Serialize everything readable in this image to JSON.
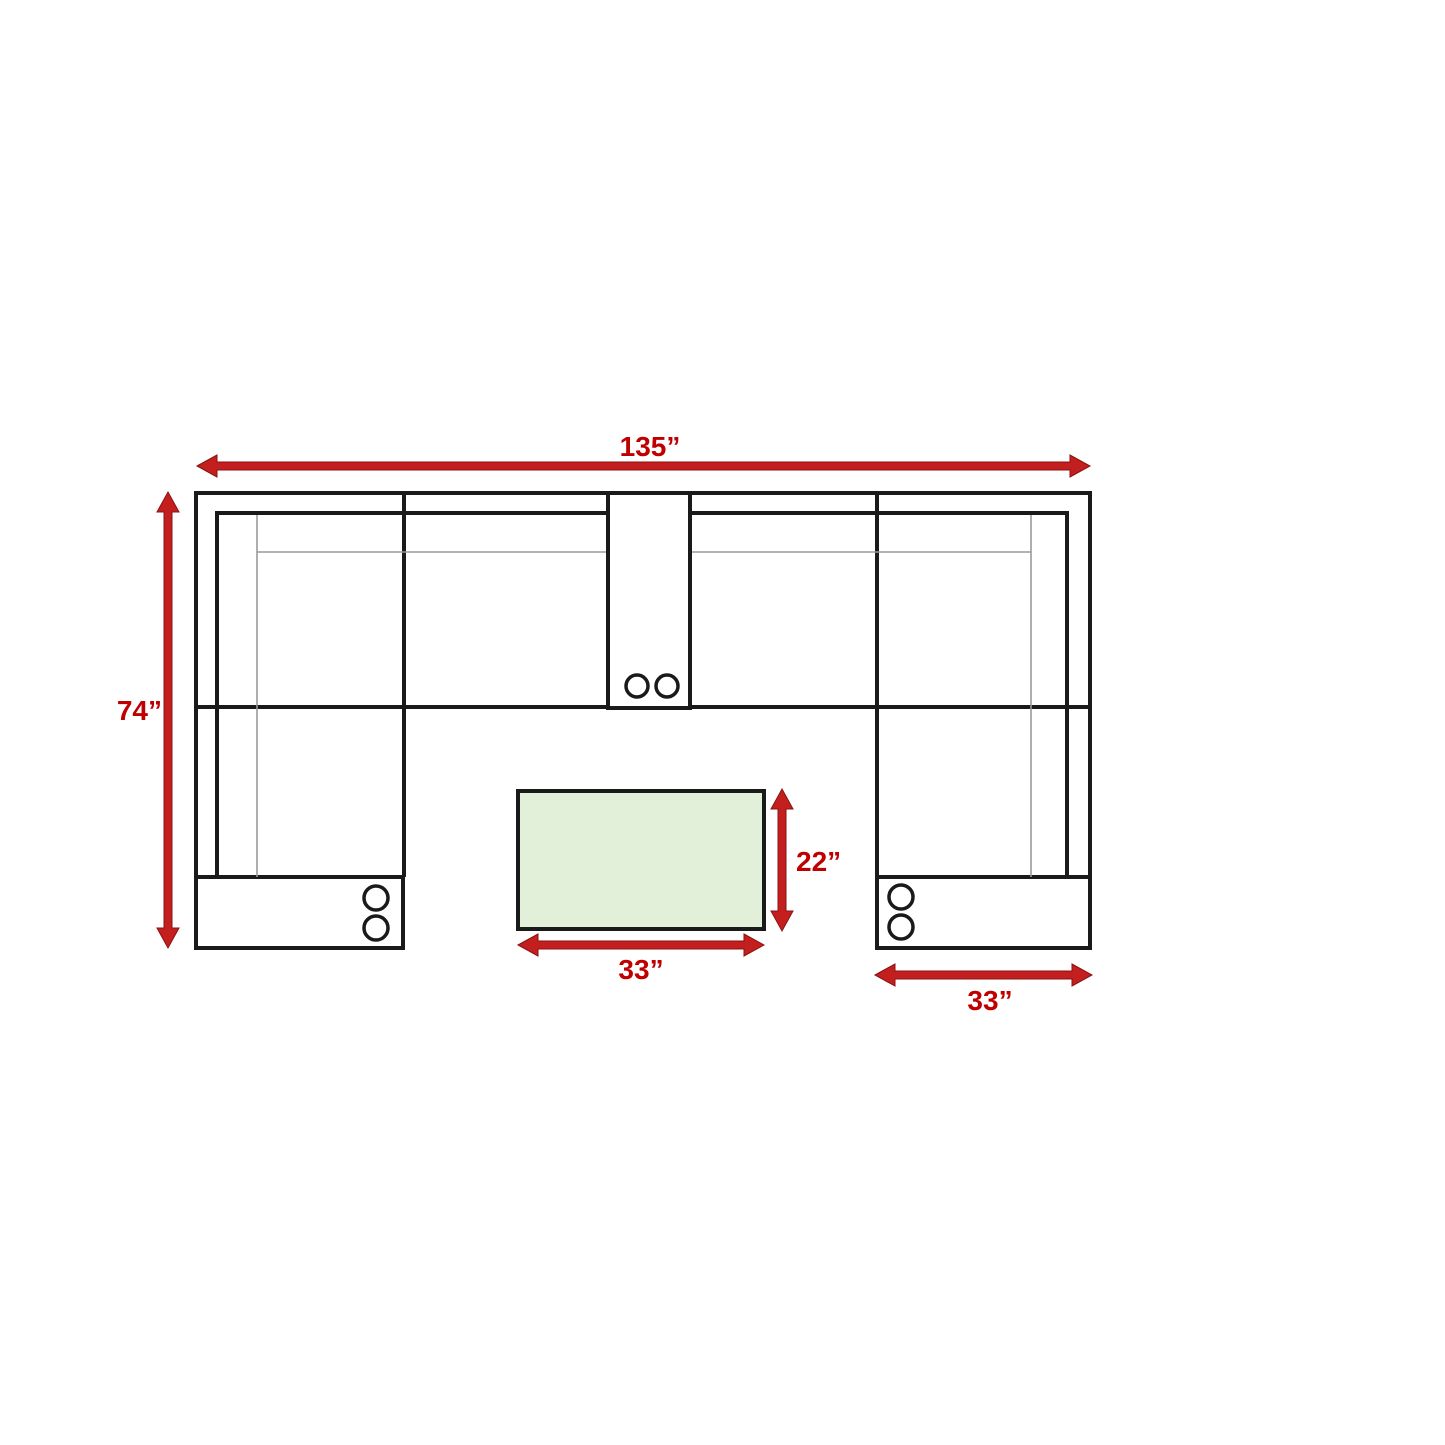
{
  "diagram": {
    "type": "sectional-sofa-floor-plan",
    "colors": {
      "background": "#ffffff",
      "outline": "#1a1a1a",
      "detail_line": "#9a9a9a",
      "arrow_fill": "#c41f1f",
      "arrow_stroke": "#8a1212",
      "label_text": "#c00000",
      "table_fill": "#e2efd9"
    },
    "labels": {
      "overall_width": "135”",
      "overall_depth": "74”",
      "table_depth": "22”",
      "table_width": "33”",
      "chaise_width": "33”"
    }
  }
}
